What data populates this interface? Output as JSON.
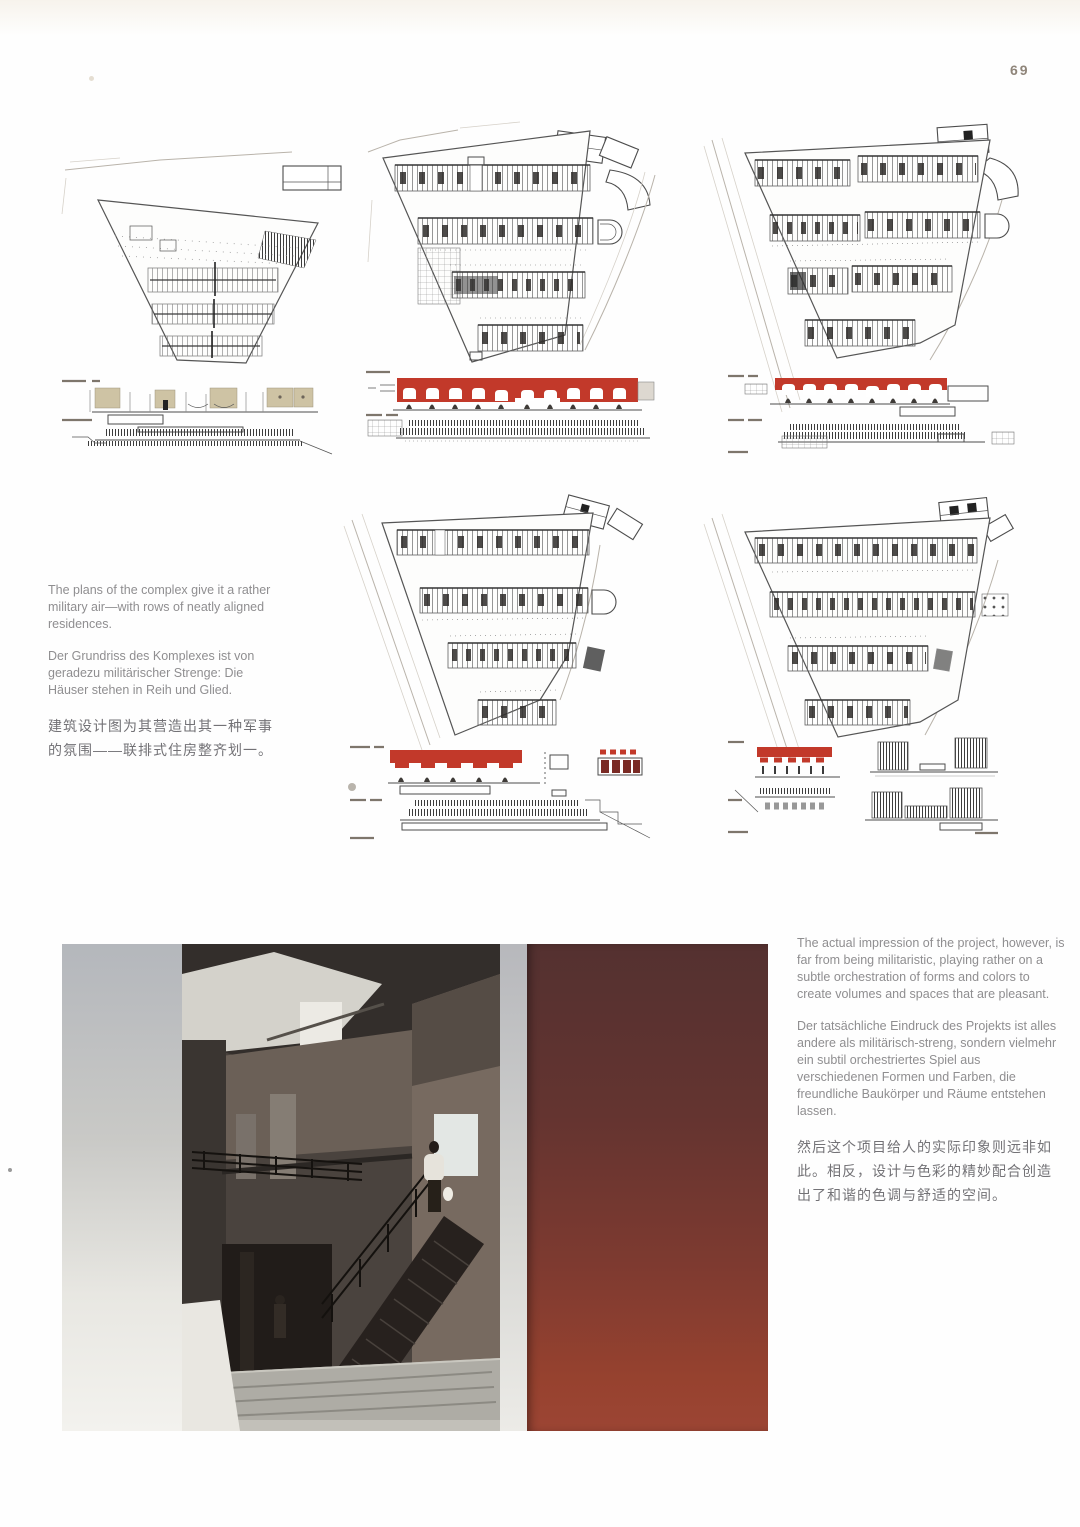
{
  "page": {
    "number": "69"
  },
  "colors": {
    "accent-red": "#c2392a",
    "maroon": "#7a2a24",
    "tan": "#cec3a4",
    "line": "#4c4c4c",
    "text-gray": "#8f8e90",
    "text-dark": "#737276",
    "wall-red-top": "#543130",
    "wall-red-bottom": "#9c4534"
  },
  "captions": {
    "left": {
      "en": "The plans of the complex give it a rather military air—with rows of neatly aligned residences.",
      "de": "Der Grundriss des Komplexes ist von geradezu militärischer Strenge: Die Häuser stehen in Reih und Glied.",
      "zh": "建筑设计图为其营造出其一种军事的氛围——联排式住房整齐划一。"
    },
    "right": {
      "en": "The actual impression of the project, however, is far from being militaristic, playing rather on a subtle orchestration of forms and colors to create volumes and spaces that are pleasant.",
      "de": "Der tatsächliche Eindruck des Projekts ist alles andere als militärisch-streng, sondern vielmehr ein subtil orchestriertes Spiel aus verschiedenen Formen und Farben, die freundliche Baukörper und Räume entstehen lassen.",
      "zh": "然后这个项目给人的实际印象则远非如此。相反，设计与色彩的精妙配合创造出了和谐的色调与舒适的空间。"
    }
  }
}
